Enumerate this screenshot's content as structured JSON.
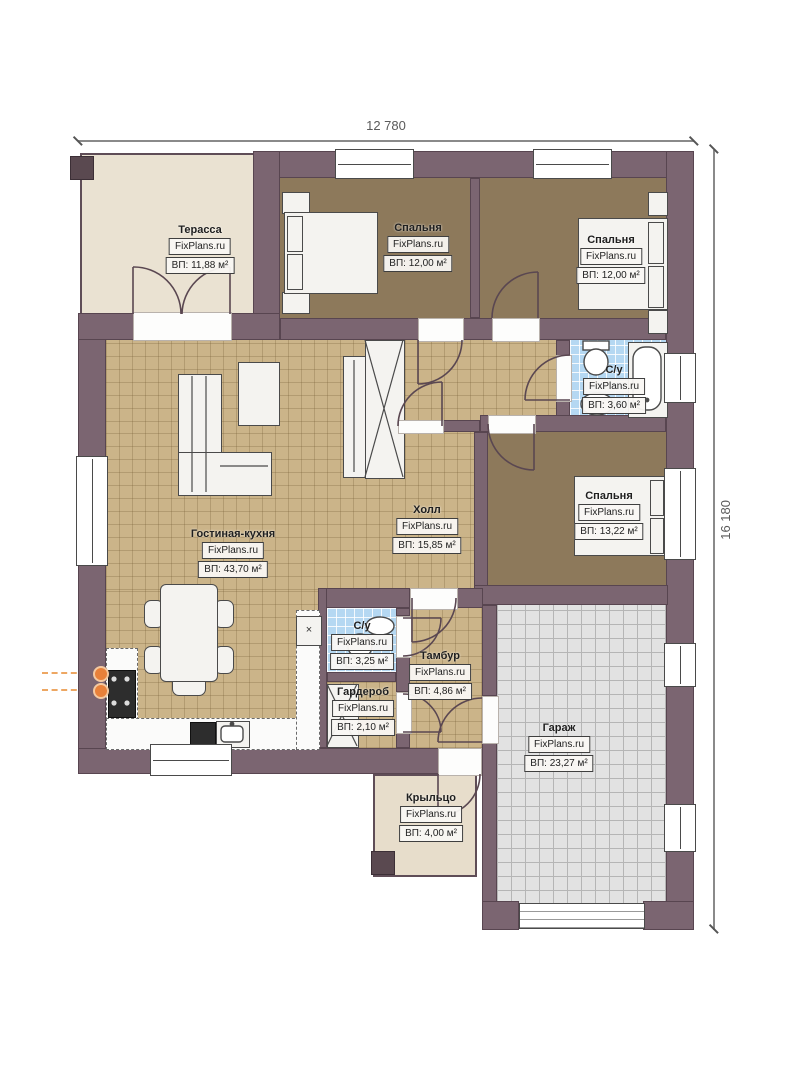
{
  "dimensions": {
    "width_label": "12 780",
    "height_label": "16 180"
  },
  "branding": {
    "watermark": "FixPlans.ru"
  },
  "rooms": {
    "terrace": {
      "name": "Терасса",
      "area": "ВП: 11,88 м²"
    },
    "bedroom1": {
      "name": "Спальня",
      "area": "ВП: 12,00 м²"
    },
    "bedroom2": {
      "name": "Спальня",
      "area": "ВП: 12,00 м²"
    },
    "bathroom1": {
      "name": "С/у",
      "area": "ВП: 3,60 м²"
    },
    "bedroom3": {
      "name": "Спальня",
      "area": "ВП: 13,22 м²"
    },
    "hall": {
      "name": "Холл",
      "area": "ВП: 15,85 м²"
    },
    "living_kitchen": {
      "name": "Гостиная-кухня",
      "area": "ВП: 43,70 м²"
    },
    "bathroom2": {
      "name": "С/у",
      "area": "ВП: 3,25 м²"
    },
    "vestibule": {
      "name": "Тамбур",
      "area": "ВП: 4,86 м²"
    },
    "wardrobe": {
      "name": "Гардероб",
      "area": "ВП: 2,10 м²"
    },
    "garage": {
      "name": "Гараж",
      "area": "ВП: 23,27 м²"
    },
    "porch": {
      "name": "Крыльцо",
      "area": "ВП: 4,00 м²"
    }
  },
  "colors": {
    "wall": "#7b6571",
    "tile_floor": "#cbb489",
    "bedroom_floor": "#8d795b",
    "bathroom_tile": "#b5d8f2",
    "garage_floor": "#e2e2e2",
    "terrace_floor": "#eae2d2",
    "porch_floor": "#e7ddcb",
    "utility_accent": "#e8813a"
  }
}
